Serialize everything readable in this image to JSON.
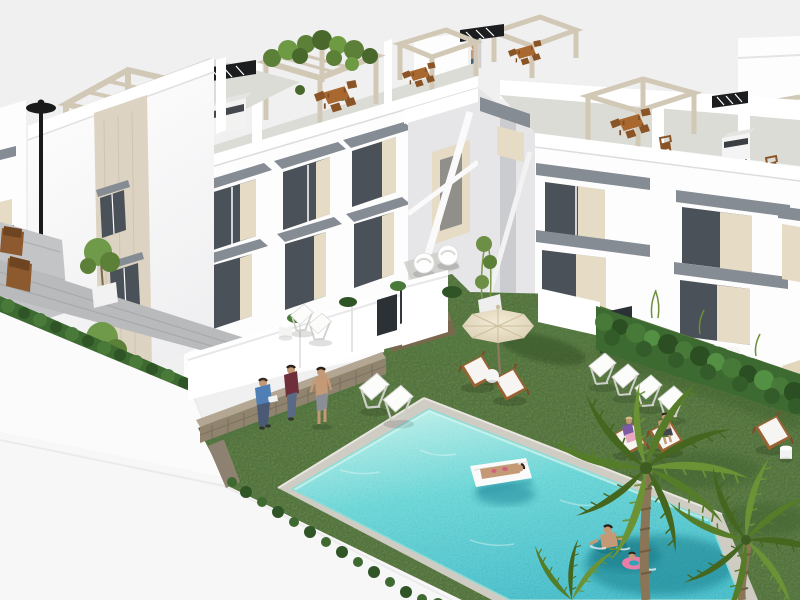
{
  "scene": {
    "kind": "3d-architectural-render",
    "subject": "new-build apartment complex with communal garden and swimming pool, aerial view",
    "objects": [
      {
        "name": "apartment-buildings",
        "description": "white two-storey modern townhouse blocks around a courtyard, beige stone accents, grey window awnings"
      },
      {
        "name": "rooftop-terraces",
        "description": "roof solariums with beige pergolas, wooden dining sets, barbecues, one pergola overgrown with green vines, person at roof shower"
      },
      {
        "name": "street-lamp",
        "description": "black street lamp at left building"
      },
      {
        "name": "communal-lawn",
        "description": "large green artificial lawn courtyard"
      },
      {
        "name": "swimming-pool",
        "description": "turquoise rectangular pool with light stone coping, seen in perspective"
      },
      {
        "name": "pool-float",
        "description": "woman sunbathing on white float mattress in pool"
      },
      {
        "name": "swimmers",
        "description": "man and child with pink swim ring in pool corner"
      },
      {
        "name": "parasol-loungers",
        "description": "beige parasol with two wooden loungers and side table"
      },
      {
        "name": "deck-chair-row",
        "description": "row of four white folding deck chairs on lawn"
      },
      {
        "name": "occupied-loungers",
        "description": "child and man lying on wooden loungers with white cushions"
      },
      {
        "name": "residents-at-wall",
        "description": "two people sitting on rustic stone retaining wall, one man standing"
      },
      {
        "name": "palm-trees",
        "description": "two palm trees overhanging pool corner"
      },
      {
        "name": "hedges",
        "description": "dark green hedges along walls and terraces"
      },
      {
        "name": "stone-steps",
        "description": "rustic stone steps from terraces down to lawn"
      },
      {
        "name": "walkway",
        "description": "grey paved walkway and decking with wooden chairs and potted trees"
      },
      {
        "name": "street",
        "description": "plain white street and perimeter wall in foreground"
      }
    ]
  },
  "palette": {
    "sky": "#f0f0f1",
    "building-white": "#fdfdfd",
    "building-shade": "#e6e6e9",
    "parapet-white": "#ffffff",
    "roof-floor": "#dcdcd6",
    "pergola-beige": "#d2c8b6",
    "stone-beige": "#ddd3c2",
    "interior-beige": "#e6dcc6",
    "awning-gray": "#858c94",
    "glass-dark": "#4b5158",
    "walkway-gray": "#b9babc",
    "decking-gray": "#c3c4c6",
    "street-white": "#f7f7f8",
    "wall-white": "#fbfbfc",
    "grass-green": "#6b9150",
    "grass-shadow": "#4f7340",
    "hedge-green": "#3c6a31",
    "hedge-light": "#549044",
    "pool-border": "#cfccc3",
    "water-light": "#b9efe8",
    "water-main": "#55cfd0",
    "water-deep": "#2fb4c2",
    "umbrella-beige": "#e9dfc6",
    "wood-brown": "#a9682f",
    "wood-dark": "#8b5426",
    "palm-green": "#5d8330",
    "palm-dark": "#44661f",
    "trunk-brown": "#8a7656",
    "stone-wall": "#90846f",
    "stone-wall-top": "#b3a794",
    "skin": "#c49a76",
    "shirt-blue": "#4f7fb5",
    "top-maroon": "#6e2f3a",
    "jeans-blue": "#5a6a85",
    "float-white": "#fafafa",
    "ring-pink": "#e87ea6",
    "lamp-black": "#1a1a1a",
    "vent-black": "#1b1d1f",
    "gate-dark": "#2c3136",
    "cushion-white": "#f6f5f2"
  }
}
